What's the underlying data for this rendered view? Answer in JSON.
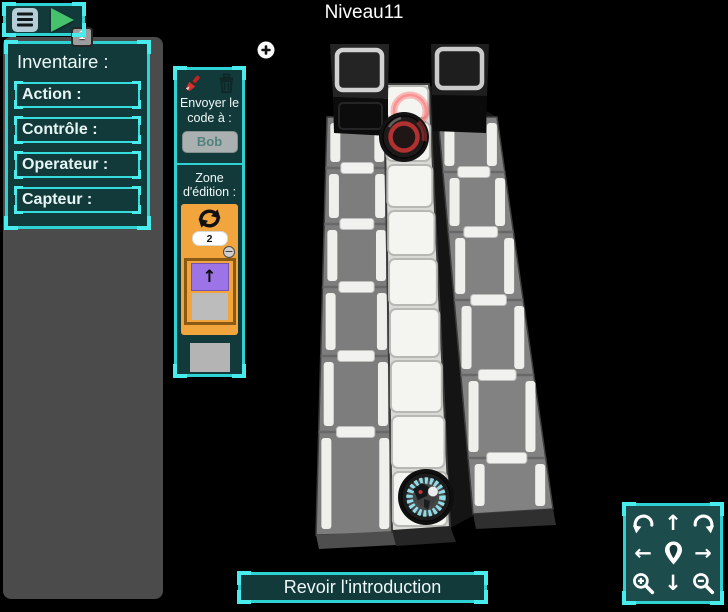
{
  "window": {
    "title": "Niveau11"
  },
  "toolbar": {
    "step_badge": "1"
  },
  "inventory": {
    "title": "Inventaire :",
    "items": [
      {
        "label": "Action :"
      },
      {
        "label": "Contrôle :"
      },
      {
        "label": "Operateur :"
      },
      {
        "label": "Capteur :"
      }
    ]
  },
  "code_panel": {
    "send_label": "Envoyer le code à :",
    "robot_name": "Bob",
    "zone_label": "Zone d'édition :",
    "loop": {
      "count": "2",
      "arrow": "↑"
    }
  },
  "nav": {
    "up": "↑",
    "down": "↓",
    "left": "←",
    "right": "→"
  },
  "footer": {
    "review_intro": "Revoir l'introduction"
  },
  "icons": {
    "minus": "−"
  },
  "colors": {
    "accent_cyan": "#2ed2d2",
    "panel_teal": "#123a3a",
    "loop_orange": "#f2a53d",
    "block_purple": "#9d74e8",
    "goal_red": "#b13030",
    "robot_ring_cyan": "#8fdce8",
    "play_green": "#46c16c",
    "sidebar_gray": "#4b4b4b"
  }
}
